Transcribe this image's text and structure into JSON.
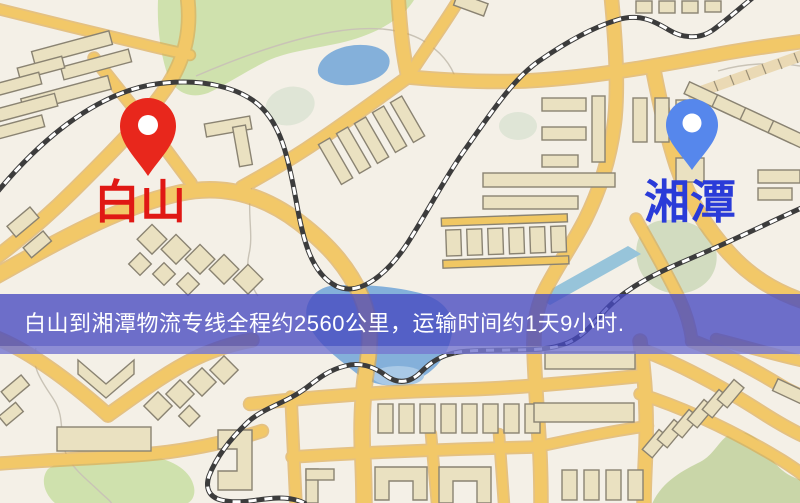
{
  "banner": {
    "text": "白山到湘潭物流专线全程约2560公里，运输时间约1天9小时.",
    "distance": "2560公里",
    "duration": "1天9小时"
  },
  "markers": {
    "origin": {
      "label": "白山"
    },
    "destination": {
      "label": "湘潭"
    }
  },
  "icons": {
    "origin_pin": "map-pin-red",
    "destination_pin": "map-pin-blue"
  },
  "colors": {
    "origin_pin": "#e8271c",
    "origin_label": "#e01814",
    "destination_pin": "#5687ec",
    "destination_label": "#2a3bd8",
    "banner_bg": "#4649c0",
    "banner_text": "#ffffff",
    "road": "#f2c868",
    "building": "#eae1c1",
    "park": "#cfe1ad",
    "water": "#84b0da",
    "railway": "#3c3c3c",
    "map_background": "#f4f0e7"
  }
}
